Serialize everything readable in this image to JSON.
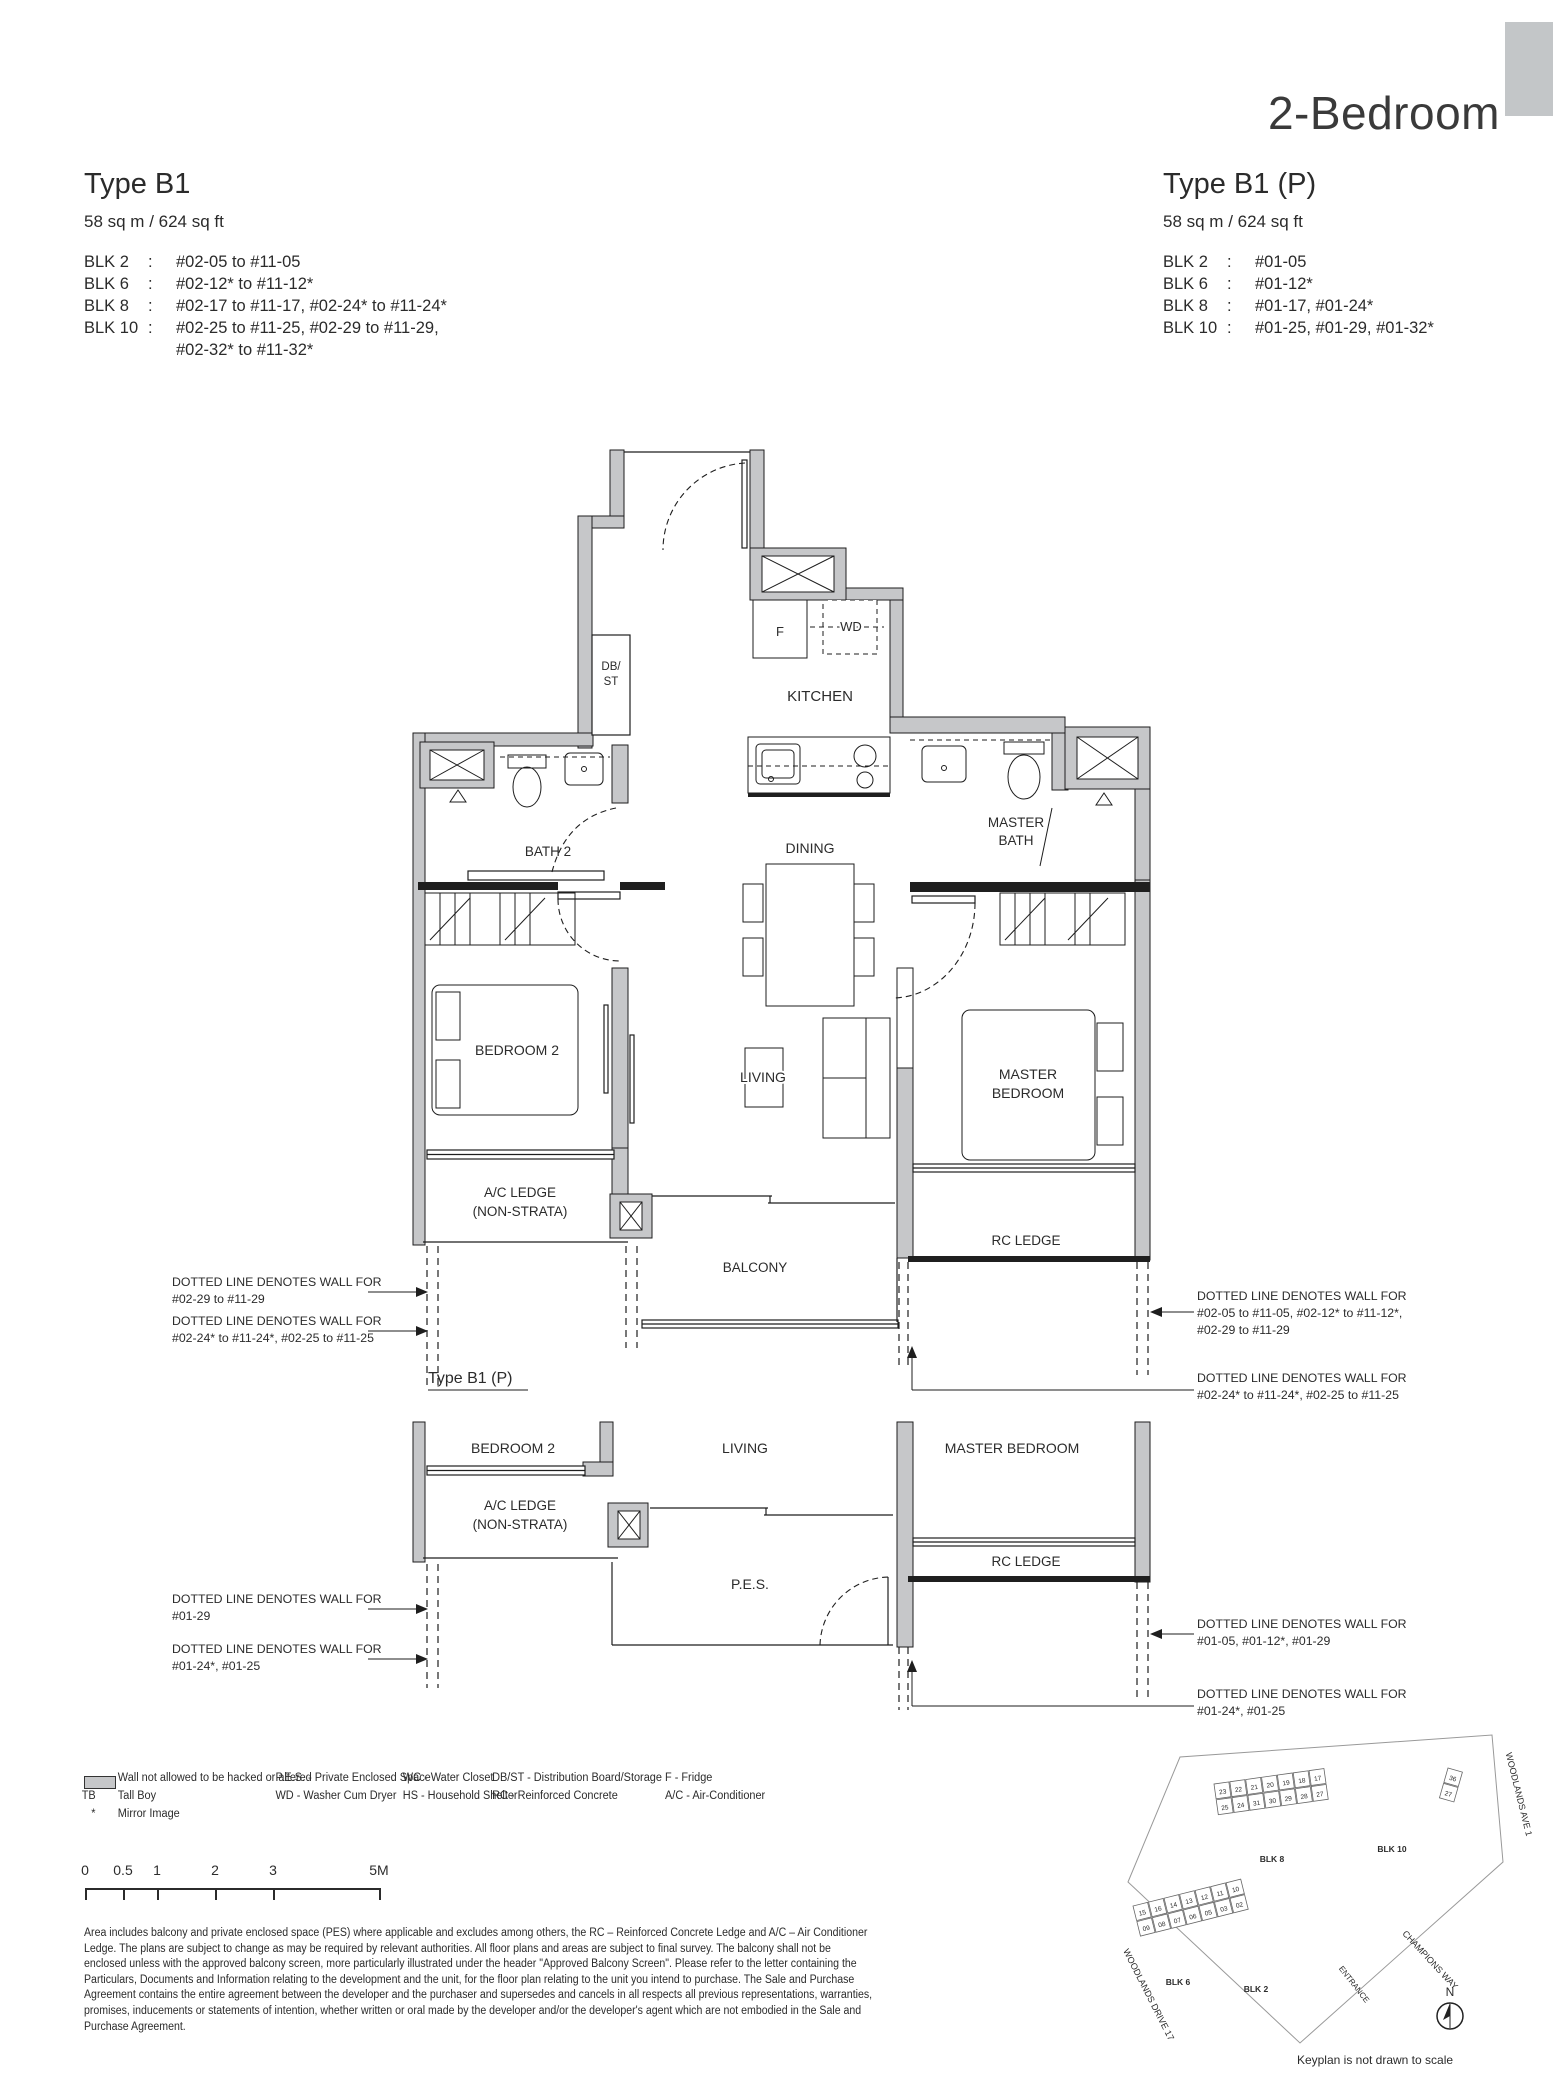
{
  "page": {
    "title": "2-Bedroom",
    "colon": ":"
  },
  "left_unit": {
    "title": "Type B1",
    "area": "58 sq m /  624 sq ft",
    "blocks": [
      {
        "label": "BLK 2",
        "units": "#02-05 to #11-05"
      },
      {
        "label": "BLK 6",
        "units": "#02-12* to #11-12*"
      },
      {
        "label": "BLK 8",
        "units": "#02-17 to #11-17, #02-24* to #11-24*"
      },
      {
        "label": "BLK 10",
        "units": "#02-25 to #11-25, #02-29 to #11-29,",
        "units2": "#02-32* to #11-32*"
      }
    ]
  },
  "right_unit": {
    "title": "Type B1 (P)",
    "area": "58 sq m /  624 sq ft",
    "blocks": [
      {
        "label": "BLK 2",
        "units": "#01-05"
      },
      {
        "label": "BLK 6",
        "units": "#01-12*"
      },
      {
        "label": "BLK 8",
        "units": "#01-17, #01-24*"
      },
      {
        "label": "BLK 10",
        "units": "#01-25, #01-29, #01-32*"
      }
    ]
  },
  "plan_labels": {
    "f": "F",
    "wd": "WD",
    "db": "DB/",
    "st": "ST",
    "kitchen": "KITCHEN",
    "dining": "DINING",
    "bath2": "BATH 2",
    "master": "MASTER",
    "bath": "BATH",
    "bedroom": "BEDROOM",
    "bedroom2": "BEDROOM 2",
    "living": "LIVING",
    "master_bedroom": "MASTER BEDROOM",
    "ac1": "A/C LEDGE",
    "ac2": "(NON-STRATA)",
    "balcony": "BALCONY",
    "rc": "RC LEDGE",
    "pes": "P.E.S."
  },
  "subplan": {
    "title": "Type B1 (P)"
  },
  "ann": {
    "d": "DOTTED LINE DENOTES WALL FOR",
    "ml1": "#02-29 to #11-29",
    "ml2": "#02-24* to #11-24*, #02-25 to #11-25",
    "mr1a": "#02-05 to #11-05, #02-12* to #11-12*,",
    "mr1b": "#02-29 to #11-29",
    "mr2": "#02-24* to #11-24*, #02-25 to #11-25",
    "sl1": "#01-29",
    "sl2": "#01-24*, #01-25",
    "sr1": "#01-05, #01-12*, #01-29",
    "sr2": "#01-24*, #01-25"
  },
  "legend": {
    "wall": "Wall not allowed to be hacked or altered",
    "tb_key": "TB",
    "tb": "Tall Boy",
    "mi_key": "*",
    "mi": "Mirror Image",
    "pes": "P.E.S. - Private Enclosed Space",
    "wd": "WD - Washer Cum Dryer",
    "wc": "WC - Water Closet",
    "hs": "HS - Household Shelter",
    "dbst": "DB/ST - Distribution Board/Storage",
    "rc": "RC - Reinforced Concrete",
    "f": "F - Fridge",
    "ac": "A/C - Air-Conditioner"
  },
  "scalebar": {
    "ticks": [
      "0",
      "0.5",
      "1",
      "2",
      "3",
      "5M"
    ]
  },
  "disclaimer": [
    "Area includes balcony and private enclosed space (PES) where applicable and excludes among others, the RC – Reinforced Concrete Ledge and A/C – Air Conditioner",
    "Ledge. The plans are subject to change as may be required by relevant authorities. All floor plans and areas are subject to final survey. The balcony shall not be",
    "enclosed unless with the approved balcony screen, more particularly illustrated under the header \"Approved Balcony Screen\". Please refer to the letter containing the",
    "Particulars, Documents and Information relating to the development and the unit, for the floor plan relating to the unit you intend to purchase. The Sale and Purchase",
    "Agreement contains the entire agreement between the developer and the purchaser and supersedes and cancels in all respects all previous representations, warranties,",
    "promises, inducements or statements of intention, whether written or oral made by the developer and/or the developer's agent which are not embodied in the Sale and",
    "Purchase Agreement."
  ],
  "keyplan": {
    "caption": "Keyplan is not drawn to scale",
    "north": "N",
    "roads": {
      "ave": "WOODLANDS AVE 1",
      "drive": "WOODLANDS DRIVE 17",
      "champ": "CHAMPIONS WAY",
      "ent": "ENTRANCE"
    },
    "blk2": "BLK 2",
    "blk6": "BLK 6",
    "blk8": "BLK 8",
    "blk10": "BLK 10",
    "clusters": [
      {
        "x": 1214,
        "y": 1784,
        "rot": -8,
        "rows": [
          [
            "23",
            "22",
            "21",
            "20",
            "19",
            "18",
            "17"
          ],
          [
            "25",
            "24",
            "31",
            "30",
            "29",
            "28",
            "27"
          ]
        ]
      },
      {
        "x": 1133,
        "y": 1906,
        "rot": -14,
        "rows": [
          [
            "15",
            "16",
            "14",
            "13",
            "12",
            "11",
            "10"
          ],
          [
            "09",
            "08",
            "07",
            "06",
            "05",
            "03",
            "02"
          ]
        ]
      },
      {
        "x": 1448,
        "y": 1768,
        "rot": 16,
        "rows": [
          [
            "36"
          ],
          [
            "27"
          ]
        ]
      }
    ]
  },
  "colors": {
    "wall": "#c6c7c9",
    "ink": "#2b2b2b"
  }
}
